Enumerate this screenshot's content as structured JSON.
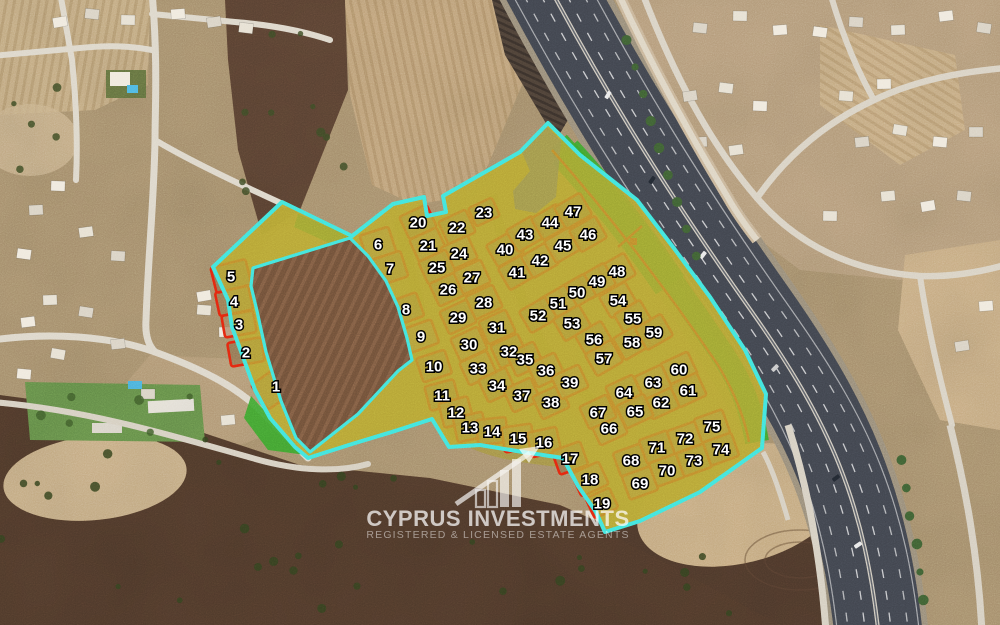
{
  "watermark": {
    "title": "CYPRUS INVESTMENTS",
    "subtitle": "REGISTERED & LICENSED ESTATE AGENTS"
  },
  "overlay_colors": {
    "boundary_cyan": "#40e4dc",
    "plot_red": "#e2260f",
    "road_olive": "#b5a433",
    "greenspace_green": "#3aa32c",
    "zone_blue": "#3b55b8"
  },
  "plots": [
    [
      1,
      276,
      386,
      -35,
      40,
      30
    ],
    [
      2,
      246,
      352,
      -10,
      34,
      24
    ],
    [
      3,
      239,
      324,
      -10,
      32,
      22
    ],
    [
      4,
      234,
      301,
      -12,
      34,
      24
    ],
    [
      5,
      231,
      276,
      -14,
      36,
      26
    ],
    [
      6,
      378,
      244,
      -18,
      30,
      27
    ],
    [
      7,
      390,
      268,
      -18,
      30,
      27
    ],
    [
      8,
      406,
      309,
      -20
    ],
    [
      9,
      421,
      336,
      -20
    ],
    [
      10,
      434,
      366,
      -18
    ],
    [
      11,
      442,
      395,
      -15
    ],
    [
      12,
      456,
      412,
      -15
    ],
    [
      13,
      470,
      427,
      -12
    ],
    [
      14,
      492,
      431,
      -6
    ],
    [
      15,
      518,
      438,
      -8
    ],
    [
      16,
      544,
      442,
      -12
    ],
    [
      17,
      570,
      458,
      -20
    ],
    [
      18,
      590,
      479,
      -25
    ],
    [
      19,
      602,
      503,
      -25,
      26,
      22
    ],
    [
      20,
      418,
      222,
      -25
    ],
    [
      21,
      428,
      245,
      -25
    ],
    [
      22,
      457,
      227,
      -25
    ],
    [
      23,
      484,
      212,
      -25,
      26,
      20
    ],
    [
      24,
      459,
      253,
      -25
    ],
    [
      25,
      437,
      267,
      -25
    ],
    [
      26,
      448,
      289,
      -25
    ],
    [
      27,
      472,
      277,
      -25
    ],
    [
      28,
      484,
      302,
      -25
    ],
    [
      29,
      458,
      317,
      -25
    ],
    [
      30,
      469,
      344,
      -25
    ],
    [
      31,
      497,
      327,
      -25
    ],
    [
      32,
      509,
      351,
      -25
    ],
    [
      33,
      478,
      368,
      -25
    ],
    [
      34,
      497,
      385,
      -25
    ],
    [
      35,
      525,
      359,
      -25
    ],
    [
      36,
      546,
      370,
      -25
    ],
    [
      37,
      522,
      395,
      -25
    ],
    [
      38,
      551,
      402,
      -25
    ],
    [
      39,
      570,
      382,
      -25
    ],
    [
      40,
      505,
      249,
      -30
    ],
    [
      41,
      517,
      272,
      -30
    ],
    [
      42,
      540,
      260,
      -30
    ],
    [
      43,
      525,
      234,
      -30
    ],
    [
      44,
      550,
      222,
      -30
    ],
    [
      45,
      563,
      245,
      -30
    ],
    [
      46,
      588,
      234,
      -30
    ],
    [
      47,
      573,
      211,
      -30
    ],
    [
      48,
      617,
      271,
      -30
    ],
    [
      49,
      597,
      281,
      -30
    ],
    [
      50,
      577,
      292,
      -30
    ],
    [
      51,
      558,
      303,
      -30
    ],
    [
      52,
      538,
      315,
      -30
    ],
    [
      53,
      572,
      323,
      -30
    ],
    [
      54,
      618,
      300,
      -30
    ],
    [
      55,
      633,
      318,
      -30
    ],
    [
      56,
      594,
      339,
      -30
    ],
    [
      57,
      604,
      358,
      -30
    ],
    [
      58,
      632,
      342,
      -30
    ],
    [
      59,
      654,
      332,
      -30
    ],
    [
      60,
      679,
      369,
      -25
    ],
    [
      61,
      688,
      390,
      -25
    ],
    [
      62,
      661,
      402,
      -25
    ],
    [
      63,
      653,
      382,
      -25
    ],
    [
      64,
      624,
      392,
      -25
    ],
    [
      65,
      635,
      411,
      -25
    ],
    [
      66,
      609,
      428,
      -25
    ],
    [
      67,
      598,
      412,
      -25
    ],
    [
      68,
      631,
      460,
      -20
    ],
    [
      69,
      640,
      483,
      -20
    ],
    [
      70,
      667,
      470,
      -20
    ],
    [
      71,
      657,
      447,
      -20
    ],
    [
      72,
      685,
      438,
      -20
    ],
    [
      73,
      694,
      460,
      -20
    ],
    [
      74,
      721,
      449,
      -20
    ],
    [
      75,
      712,
      426,
      -20
    ]
  ]
}
